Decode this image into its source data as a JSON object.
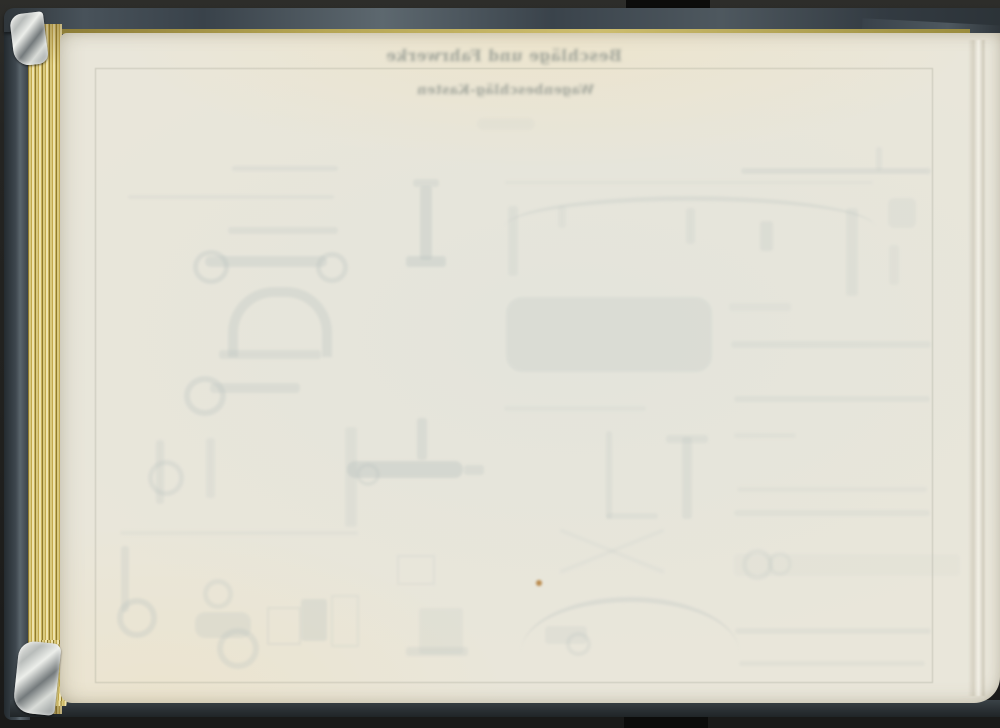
{
  "showthrough_text": {
    "line1": "Beschläge und Fahrwerke",
    "line2": "Wagenbeschläg-Kasten"
  },
  "colors": {
    "background_black": "#21211f",
    "cover_slate": "#3d464d",
    "gilt_edge_gold": "#c9b35e",
    "page_cream": "#e9e6da",
    "ghost_ink": "#b9c2bf",
    "foxing_spot": "#b5813e"
  },
  "ghost_shapes": [
    {
      "t": "bar",
      "x": 232,
      "y": 166,
      "w": 106,
      "h": 5,
      "o": 0.2
    },
    {
      "t": "bar",
      "x": 128,
      "y": 195,
      "w": 206,
      "h": 4,
      "o": 0.16
    },
    {
      "t": "bar",
      "x": 228,
      "y": 227,
      "w": 110,
      "h": 7,
      "o": 0.22
    },
    {
      "t": "bar",
      "x": 205,
      "y": 256,
      "w": 122,
      "h": 11,
      "o": 0.3,
      "rad": 5
    },
    {
      "t": "ring",
      "x": 193,
      "y": 250,
      "w": 26,
      "h": 24,
      "o": 0.32,
      "b": 5
    },
    {
      "t": "ring",
      "x": 316,
      "y": 252,
      "w": 22,
      "h": 21,
      "o": 0.3,
      "b": 5
    },
    {
      "t": "bar",
      "x": 420,
      "y": 186,
      "w": 12,
      "h": 74,
      "o": 0.34
    },
    {
      "t": "bar",
      "x": 406,
      "y": 256,
      "w": 40,
      "h": 11,
      "o": 0.34
    },
    {
      "t": "bar",
      "x": 413,
      "y": 179,
      "w": 26,
      "h": 8,
      "o": 0.26
    },
    {
      "t": "archu",
      "x": 228,
      "y": 287,
      "w": 84,
      "h": 60,
      "o": 0.3
    },
    {
      "t": "bar",
      "x": 219,
      "y": 350,
      "w": 102,
      "h": 9,
      "o": 0.26
    },
    {
      "t": "ring",
      "x": 184,
      "y": 376,
      "w": 30,
      "h": 28,
      "o": 0.3,
      "b": 6
    },
    {
      "t": "bar",
      "x": 210,
      "y": 383,
      "w": 90,
      "h": 10,
      "o": 0.26,
      "rad": 4
    },
    {
      "t": "bar",
      "x": 156,
      "y": 440,
      "w": 8,
      "h": 64,
      "o": 0.22
    },
    {
      "t": "ring",
      "x": 148,
      "y": 460,
      "w": 26,
      "h": 26,
      "o": 0.26,
      "b": 5
    },
    {
      "t": "bar",
      "x": 206,
      "y": 438,
      "w": 9,
      "h": 60,
      "o": 0.18
    },
    {
      "t": "bar",
      "x": 345,
      "y": 427,
      "w": 12,
      "h": 100,
      "o": 0.18
    },
    {
      "t": "bar",
      "x": 347,
      "y": 461,
      "w": 116,
      "h": 17,
      "o": 0.38,
      "rad": 8
    },
    {
      "t": "ring",
      "x": 356,
      "y": 463,
      "w": 16,
      "h": 15,
      "o": 0.25,
      "b": 4
    },
    {
      "t": "bar",
      "x": 464,
      "y": 465,
      "w": 20,
      "h": 10,
      "o": 0.26
    },
    {
      "t": "bar",
      "x": 417,
      "y": 418,
      "w": 10,
      "h": 42,
      "o": 0.28
    },
    {
      "t": "bar",
      "x": 120,
      "y": 531,
      "w": 238,
      "h": 4,
      "o": 0.13
    },
    {
      "t": "bar",
      "x": 121,
      "y": 546,
      "w": 8,
      "h": 66,
      "o": 0.24
    },
    {
      "t": "ring",
      "x": 117,
      "y": 598,
      "w": 28,
      "h": 28,
      "o": 0.3,
      "b": 6
    },
    {
      "t": "ring",
      "x": 203,
      "y": 579,
      "w": 20,
      "h": 20,
      "o": 0.24,
      "b": 5
    },
    {
      "t": "bar",
      "x": 195,
      "y": 612,
      "w": 56,
      "h": 26,
      "o": 0.24,
      "rad": 10
    },
    {
      "t": "ring",
      "x": 217,
      "y": 628,
      "w": 30,
      "h": 29,
      "o": 0.28,
      "b": 6
    },
    {
      "t": "out",
      "x": 267,
      "y": 607,
      "w": 30,
      "h": 34,
      "o": 0.24
    },
    {
      "t": "bar",
      "x": 301,
      "y": 599,
      "w": 26,
      "h": 42,
      "o": 0.28
    },
    {
      "t": "out",
      "x": 331,
      "y": 595,
      "w": 24,
      "h": 48,
      "o": 0.2
    },
    {
      "t": "out",
      "x": 397,
      "y": 555,
      "w": 34,
      "h": 26,
      "o": 0.18
    },
    {
      "t": "bar",
      "x": 419,
      "y": 608,
      "w": 44,
      "h": 46,
      "o": 0.16
    },
    {
      "t": "bar",
      "x": 406,
      "y": 647,
      "w": 62,
      "h": 9,
      "o": 0.22
    },
    {
      "t": "bar",
      "x": 477,
      "y": 118,
      "w": 58,
      "h": 12,
      "o": 0.1,
      "rad": 6
    },
    {
      "t": "bar",
      "x": 505,
      "y": 181,
      "w": 368,
      "h": 3,
      "o": 0.13
    },
    {
      "t": "arc",
      "x": 505,
      "y": 196,
      "w": 370,
      "h": 26,
      "o": 0.25
    },
    {
      "t": "bar",
      "x": 508,
      "y": 206,
      "w": 10,
      "h": 70,
      "o": 0.18
    },
    {
      "t": "bar",
      "x": 558,
      "y": 206,
      "w": 8,
      "h": 22,
      "o": 0.14
    },
    {
      "t": "bar",
      "x": 686,
      "y": 208,
      "w": 9,
      "h": 36,
      "o": 0.18
    },
    {
      "t": "bar",
      "x": 846,
      "y": 208,
      "w": 12,
      "h": 88,
      "o": 0.18
    },
    {
      "t": "bar",
      "x": 506,
      "y": 297,
      "w": 206,
      "h": 75,
      "o": 0.22,
      "rad": 16
    },
    {
      "t": "bar",
      "x": 729,
      "y": 303,
      "w": 62,
      "h": 8,
      "o": 0.13
    },
    {
      "t": "bar",
      "x": 504,
      "y": 406,
      "w": 142,
      "h": 5,
      "o": 0.13
    },
    {
      "t": "bar",
      "x": 606,
      "y": 431,
      "w": 6,
      "h": 88,
      "o": 0.2
    },
    {
      "t": "bar",
      "x": 606,
      "y": 513,
      "w": 52,
      "h": 6,
      "o": 0.18
    },
    {
      "t": "bar",
      "x": 682,
      "y": 437,
      "w": 10,
      "h": 82,
      "o": 0.22
    },
    {
      "t": "bar",
      "x": 666,
      "y": 435,
      "w": 42,
      "h": 8,
      "o": 0.2
    },
    {
      "t": "bar",
      "x": 556,
      "y": 549,
      "w": 112,
      "h": 4,
      "o": 0.12,
      "rot": 22
    },
    {
      "t": "bar",
      "x": 556,
      "y": 549,
      "w": 112,
      "h": 4,
      "o": 0.12,
      "rot": -22
    },
    {
      "t": "arc",
      "x": 521,
      "y": 597,
      "w": 218,
      "h": 50,
      "o": 0.28
    },
    {
      "t": "bar",
      "x": 545,
      "y": 626,
      "w": 42,
      "h": 18,
      "o": 0.18,
      "rad": 4
    },
    {
      "t": "ring",
      "x": 566,
      "y": 632,
      "w": 17,
      "h": 16,
      "o": 0.22,
      "b": 4
    },
    {
      "t": "dot",
      "x": 536,
      "y": 580,
      "w": 6,
      "h": 6,
      "o": 0.9,
      "c": "#b5813e"
    },
    {
      "t": "bar",
      "x": 741,
      "y": 168,
      "w": 190,
      "h": 6,
      "o": 0.24
    },
    {
      "t": "bar",
      "x": 876,
      "y": 147,
      "w": 6,
      "h": 24,
      "o": 0.18
    },
    {
      "t": "bar",
      "x": 888,
      "y": 198,
      "w": 28,
      "h": 30,
      "o": 0.16,
      "rad": 6
    },
    {
      "t": "bar",
      "x": 760,
      "y": 221,
      "w": 13,
      "h": 30,
      "o": 0.22
    },
    {
      "t": "bar",
      "x": 889,
      "y": 245,
      "w": 10,
      "h": 40,
      "o": 0.14
    },
    {
      "t": "bar",
      "x": 731,
      "y": 341,
      "w": 200,
      "h": 7,
      "o": 0.18
    },
    {
      "t": "bar",
      "x": 734,
      "y": 396,
      "w": 196,
      "h": 6,
      "o": 0.18
    },
    {
      "t": "bar",
      "x": 734,
      "y": 433,
      "w": 62,
      "h": 5,
      "o": 0.13
    },
    {
      "t": "bar",
      "x": 737,
      "y": 487,
      "w": 190,
      "h": 5,
      "o": 0.13
    },
    {
      "t": "bar",
      "x": 734,
      "y": 510,
      "w": 196,
      "h": 6,
      "o": 0.16
    },
    {
      "t": "bar",
      "x": 734,
      "y": 554,
      "w": 226,
      "h": 22,
      "o": 0.08,
      "rad": 4
    },
    {
      "t": "ring",
      "x": 742,
      "y": 549,
      "w": 21,
      "h": 21,
      "o": 0.18,
      "b": 5
    },
    {
      "t": "ring",
      "x": 768,
      "y": 552,
      "w": 16,
      "h": 16,
      "o": 0.15,
      "b": 4
    },
    {
      "t": "bar",
      "x": 735,
      "y": 628,
      "w": 196,
      "h": 6,
      "o": 0.18
    },
    {
      "t": "bar",
      "x": 739,
      "y": 661,
      "w": 186,
      "h": 5,
      "o": 0.16
    }
  ]
}
